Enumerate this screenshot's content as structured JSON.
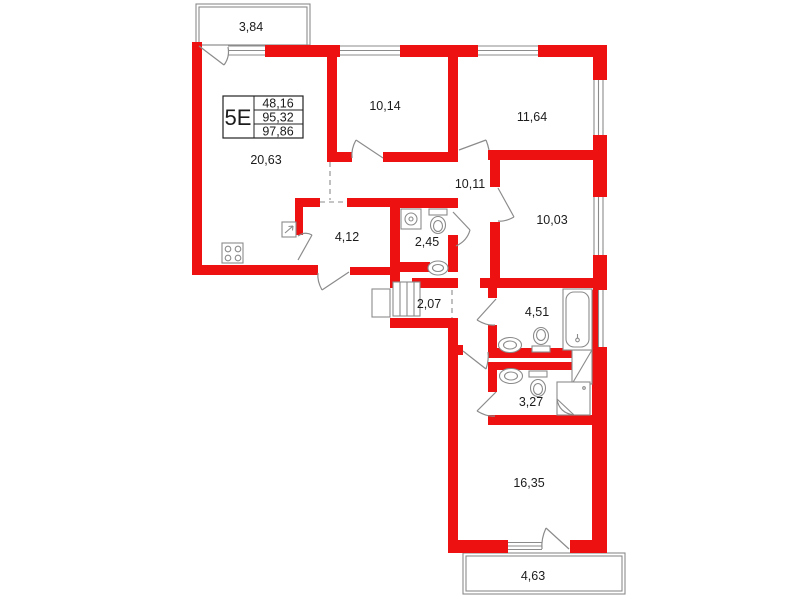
{
  "colors": {
    "wall_red": "#ee1111",
    "line_gray": "#8b8b8b",
    "text_dark": "#1c1c1c"
  },
  "unit": {
    "label": "5Е",
    "areas": [
      "48,16",
      "95,32",
      "97,86"
    ]
  },
  "rooms": {
    "balcony_top": {
      "area": "3,84"
    },
    "living_kitchen": {
      "area": "20,63"
    },
    "bedroom_top_middle": {
      "area": "10,14"
    },
    "bedroom_top_right": {
      "area": "11,64"
    },
    "hallway": {
      "area": "10,11"
    },
    "bedroom_right": {
      "area": "10,03"
    },
    "closet": {
      "area": "4,12"
    },
    "bathroom_small": {
      "area": "2,45"
    },
    "hall_small": {
      "area": "2,07"
    },
    "bathroom_large": {
      "area": "4,51"
    },
    "bathroom_lower": {
      "area": "3,27"
    },
    "bedroom_bottom": {
      "area": "16,35"
    },
    "balcony_bottom": {
      "area": "4,63"
    }
  }
}
